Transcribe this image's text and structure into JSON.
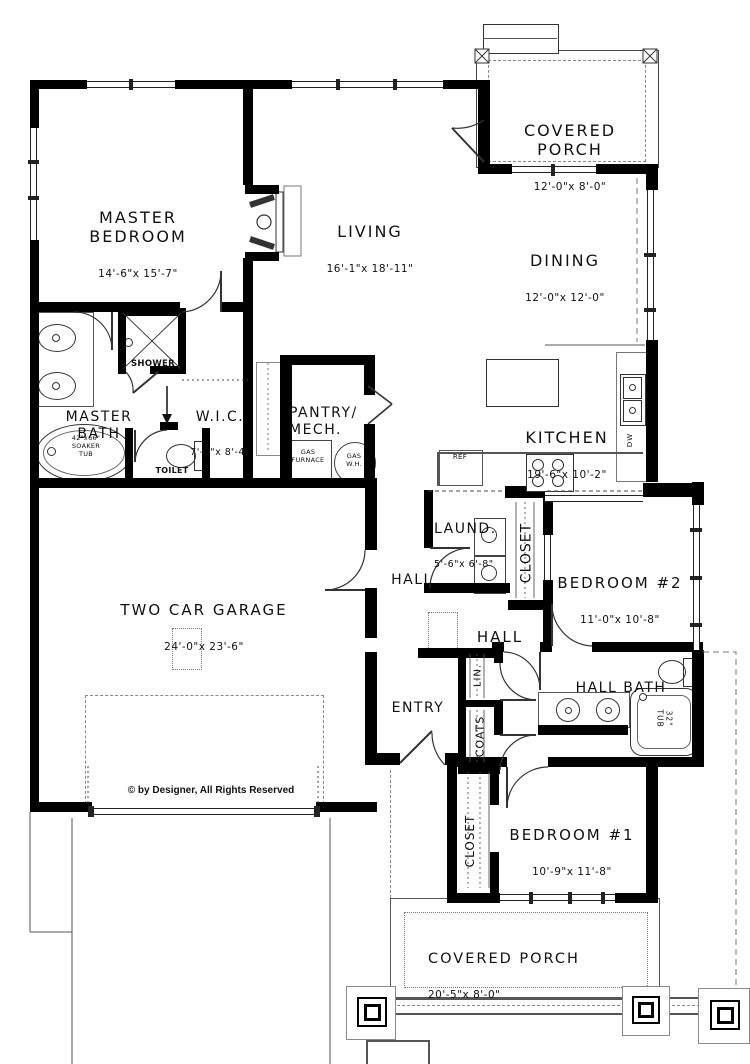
{
  "rooms": {
    "covered_porch_top": {
      "name": "COVERED\nPORCH",
      "dims": "12'-0\"x 8'-0\""
    },
    "master_bedroom": {
      "name": "MASTER\nBEDROOM",
      "dims": "14'-6\"x 15'-7\""
    },
    "living": {
      "name": "LIVING",
      "dims": "16'-1\"x 18'-11\""
    },
    "dining": {
      "name": "DINING",
      "dims": "12'-0\"x 12'-0\""
    },
    "master_bath": {
      "name": "MASTER\nBATH",
      "dims": ""
    },
    "wic": {
      "name": "W.I.C.",
      "dims": "7'-0\"x 8'-4\""
    },
    "pantry_mech": {
      "name": "PANTRY/\nMECH.",
      "dims": ""
    },
    "kitchen": {
      "name": "KITCHEN",
      "dims": "19'-6\"x 10'-2\""
    },
    "laundry": {
      "name": "LAUND.",
      "dims": "5'-6\"x 6'-8\""
    },
    "bedroom2": {
      "name": "BEDROOM #2",
      "dims": "11'-0\"x 10'-8\""
    },
    "garage": {
      "name": "TWO CAR GARAGE",
      "dims": "24'-0\"x 23'-6\""
    },
    "hall_upper": {
      "name": "HALL"
    },
    "hall_lower": {
      "name": "HALL"
    },
    "entry": {
      "name": "ENTRY"
    },
    "hall_bath": {
      "name": "HALL BATH"
    },
    "bedroom1": {
      "name": "BEDROOM #1",
      "dims": "10'-9\"x 11'-8\""
    },
    "covered_porch_bottom": {
      "name": "COVERED PORCH",
      "dims": "20'-5\"x 8'-0\""
    }
  },
  "closets": {
    "lin": "LIN.",
    "coats": "COATS",
    "laundry_closet": "CLOSET",
    "bedroom1_closet": "CLOSET"
  },
  "fixtures": {
    "shower": "SHOWER",
    "toilet": "TOILET",
    "soaker_tub": "42\"x66\"\nSOAKER\nTUB",
    "gas_furnace": "GAS\nFURNACE",
    "gas_wh": "GAS\nW.H.",
    "ref": "REF",
    "dw": "DW",
    "hall_tub": "32\"\nTUB"
  },
  "footer": {
    "copyright": "© by Designer, All Rights Reserved"
  },
  "colors": {
    "wall": "#000000",
    "line": "#333333",
    "dash": "#888888"
  }
}
